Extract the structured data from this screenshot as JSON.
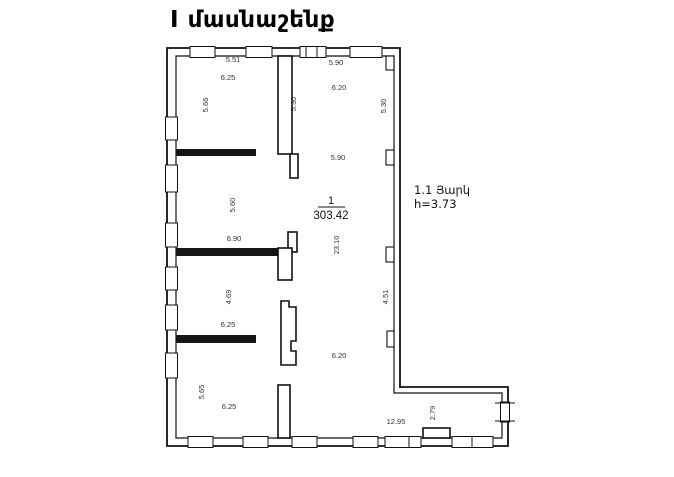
{
  "title": "I մասնաշենք",
  "floor_note": {
    "line1": "1.1 Յարկ",
    "line2": "h=3.73"
  },
  "room": {
    "number": "1",
    "area": "303.42"
  },
  "dimensions": [
    {
      "text": "5.51",
      "x": 233,
      "y": 60,
      "vertical": false
    },
    {
      "text": "6.25",
      "x": 228,
      "y": 78,
      "vertical": false
    },
    {
      "text": "5.66",
      "x": 206,
      "y": 105,
      "vertical": true
    },
    {
      "text": "5.90",
      "x": 336,
      "y": 63,
      "vertical": false
    },
    {
      "text": "6.20",
      "x": 339,
      "y": 88,
      "vertical": false
    },
    {
      "text": "5.30",
      "x": 294,
      "y": 104,
      "vertical": true
    },
    {
      "text": "5.30",
      "x": 384,
      "y": 106,
      "vertical": true
    },
    {
      "text": "5.90",
      "x": 338,
      "y": 158,
      "vertical": false
    },
    {
      "text": "5.60",
      "x": 233,
      "y": 205,
      "vertical": true
    },
    {
      "text": "6.90",
      "x": 234,
      "y": 239,
      "vertical": false
    },
    {
      "text": "23.10",
      "x": 337,
      "y": 245,
      "vertical": true
    },
    {
      "text": "4.69",
      "x": 229,
      "y": 297,
      "vertical": true
    },
    {
      "text": "6.25",
      "x": 228,
      "y": 325,
      "vertical": false
    },
    {
      "text": "4.51",
      "x": 386,
      "y": 297,
      "vertical": true
    },
    {
      "text": "6.20",
      "x": 339,
      "y": 356,
      "vertical": false
    },
    {
      "text": "5.65",
      "x": 202,
      "y": 392,
      "vertical": true
    },
    {
      "text": "6.25",
      "x": 229,
      "y": 407,
      "vertical": false
    },
    {
      "text": "12.95",
      "x": 396,
      "y": 422,
      "vertical": false
    },
    {
      "text": "2.79",
      "x": 433,
      "y": 413,
      "vertical": true
    }
  ],
  "colors": {
    "line": "#111111",
    "dim_text": "#333333",
    "background": "#ffffff"
  }
}
